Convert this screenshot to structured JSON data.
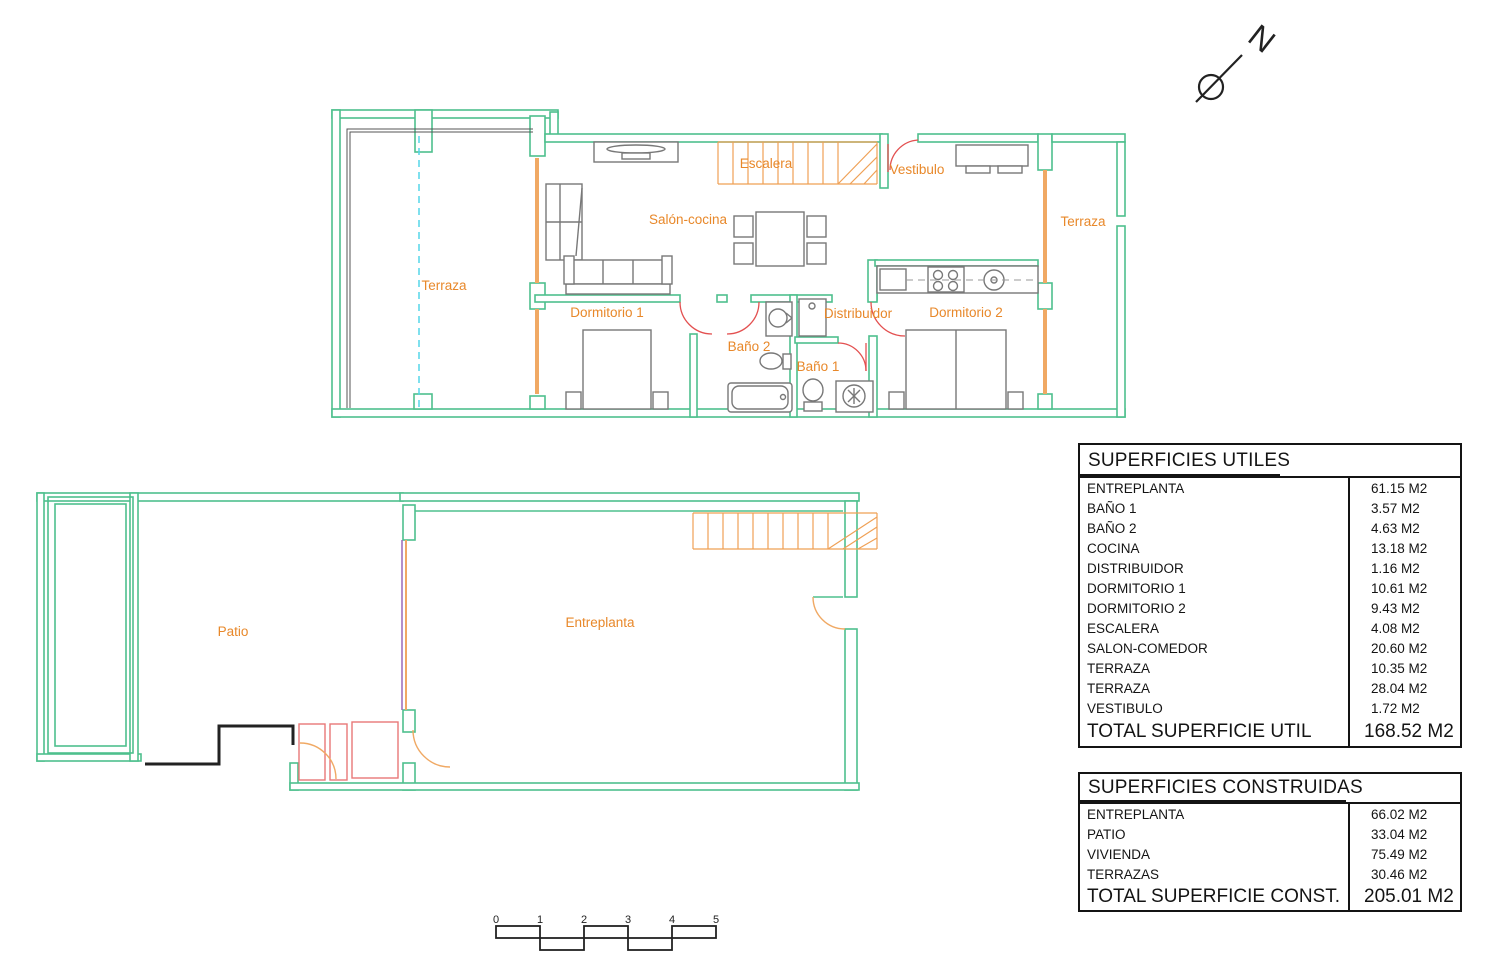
{
  "north": {
    "label": "N"
  },
  "plan_upper": {
    "name": "Vivienda - planta superior",
    "rooms": [
      {
        "id": "terraza-left",
        "label": "Terraza"
      },
      {
        "id": "salon-cocina",
        "label": "Salón-cocina"
      },
      {
        "id": "escalera",
        "label": "Escalera"
      },
      {
        "id": "vestibulo",
        "label": "Vestibulo"
      },
      {
        "id": "terraza-right",
        "label": "Terraza"
      },
      {
        "id": "dormitorio-1",
        "label": "Dormitorio 1"
      },
      {
        "id": "bano-2",
        "label": "Baño 2"
      },
      {
        "id": "bano-1",
        "label": "Baño 1"
      },
      {
        "id": "distribuidor",
        "label": "Distribuidor"
      },
      {
        "id": "dormitorio-2",
        "label": "Dormitorio 2"
      }
    ]
  },
  "plan_lower": {
    "name": "Entreplanta y patio",
    "rooms": [
      {
        "id": "patio",
        "label": "Patio"
      },
      {
        "id": "entreplanta",
        "label": "Entreplanta"
      }
    ]
  },
  "tables": {
    "utiles": {
      "title": "SUPERFICIES UTILES",
      "rows": [
        {
          "label": "ENTREPLANTA",
          "value": "61.15 M2"
        },
        {
          "label": "BAÑO 1",
          "value": "3.57 M2"
        },
        {
          "label": "BAÑO 2",
          "value": "4.63 M2"
        },
        {
          "label": "COCINA",
          "value": "13.18 M2"
        },
        {
          "label": "DISTRIBUIDOR",
          "value": "1.16 M2"
        },
        {
          "label": "DORMITORIO 1",
          "value": "10.61 M2"
        },
        {
          "label": "DORMITORIO 2",
          "value": "9.43 M2"
        },
        {
          "label": "ESCALERA",
          "value": "4.08 M2"
        },
        {
          "label": "SALON-COMEDOR",
          "value": "20.60 M2"
        },
        {
          "label": "TERRAZA",
          "value": "10.35 M2"
        },
        {
          "label": "TERRAZA",
          "value": "28.04 M2"
        },
        {
          "label": "VESTIBULO",
          "value": "1.72 M2"
        }
      ],
      "total_label": "TOTAL SUPERFICIE UTIL",
      "total_value": "168.52 M2"
    },
    "construidas": {
      "title": "SUPERFICIES CONSTRUIDAS",
      "rows": [
        {
          "label": "ENTREPLANTA",
          "value": "66.02 M2"
        },
        {
          "label": "PATIO",
          "value": "33.04 M2"
        },
        {
          "label": "VIVIENDA",
          "value": "75.49 M2"
        },
        {
          "label": "TERRAZAS",
          "value": "30.46 M2"
        }
      ],
      "total_label": "TOTAL SUPERFICIE CONST.",
      "total_value": "205.01 M2"
    }
  },
  "scalebar": {
    "ticks": [
      "0",
      "1",
      "2",
      "3",
      "4",
      "5"
    ]
  },
  "colors": {
    "wall_green": "#4ec08d",
    "label_orange": "#e8882a",
    "window_orange": "#f0a964",
    "stair_orange": "#efa055",
    "door_red": "#e35050",
    "patio_red": "#e87878",
    "glass_cyan": "#55d5e8",
    "purple": "#9a6ab8",
    "furniture_gray": "#787878",
    "line_black": "#141414"
  }
}
